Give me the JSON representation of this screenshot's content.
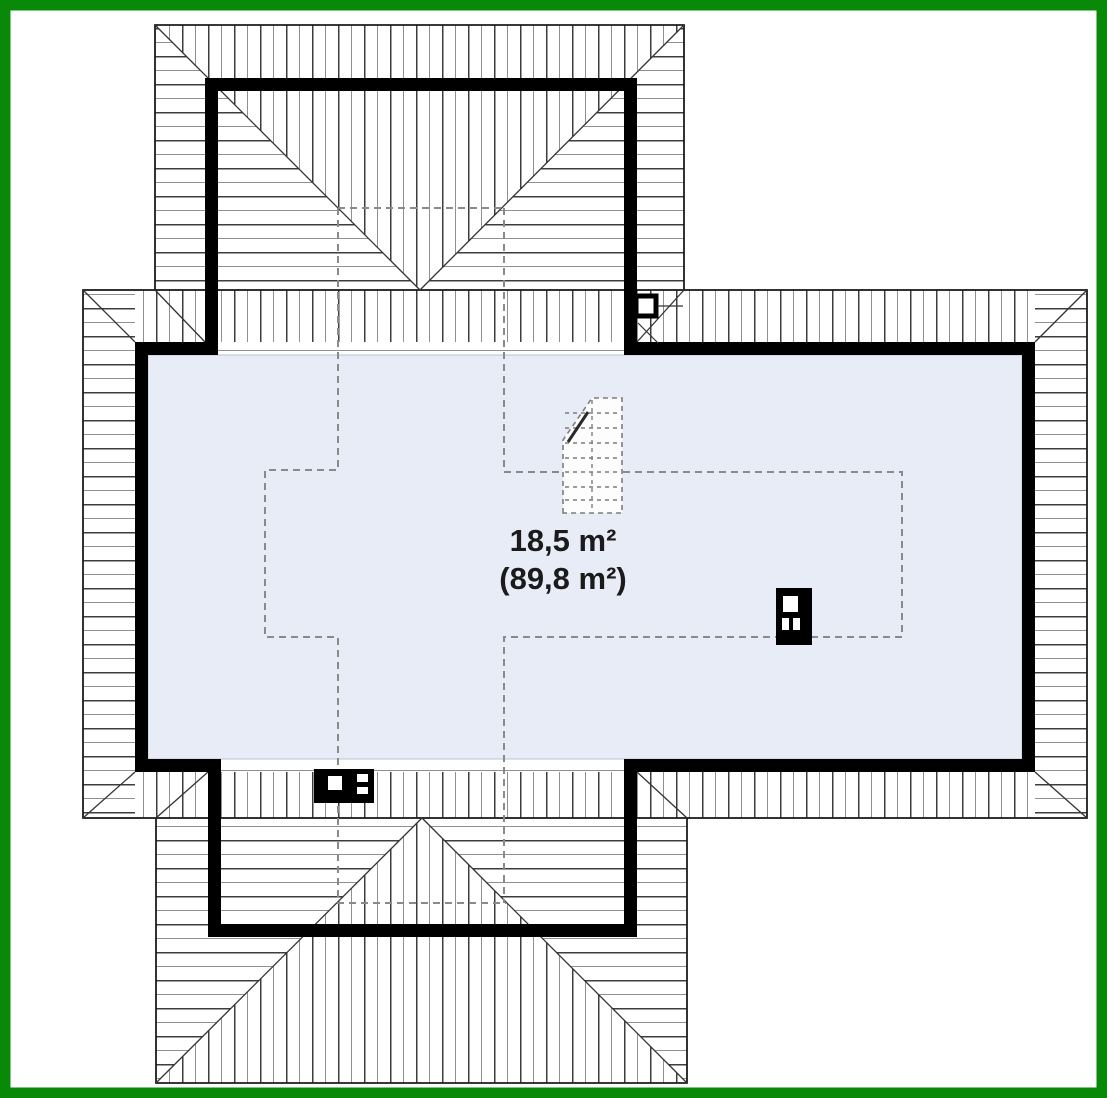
{
  "plan": {
    "title": "attic-roof-floor-plan",
    "room": {
      "usable_area": "18,5 m²",
      "total_area": "(89,8 m²)"
    },
    "features": [
      "hipped-roof-top-wing",
      "hipped-roof-bottom-wing",
      "main-attic-room",
      "headroom-dashed-outline",
      "staircase",
      "roof-chimney-top",
      "chimney-right",
      "chimney-bottom"
    ]
  },
  "colors": {
    "frame": "#088a08",
    "background": "#ffffff",
    "floor": "#e8ecf6",
    "wall": "#000000",
    "hatch_dark": "#3d3d3d",
    "hatch_light": "#909090",
    "dashed_line": "#8a8a8a",
    "outline": "#1c1c1c"
  }
}
